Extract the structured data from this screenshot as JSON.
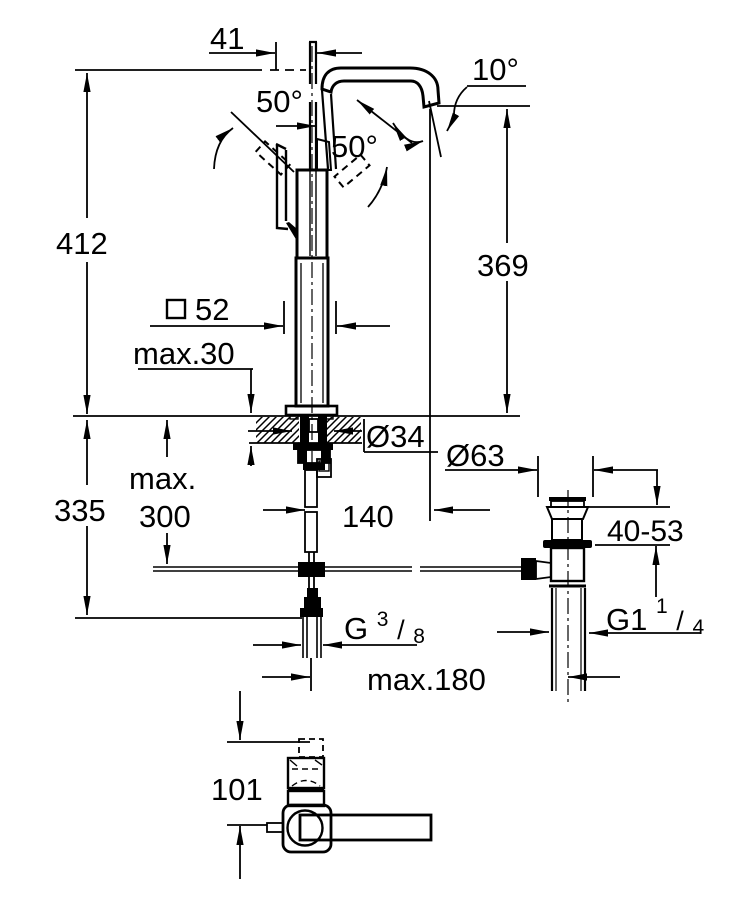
{
  "drawing": {
    "kind": "faucet-installation-dimensions",
    "dimensions": {
      "spout_offset": "41",
      "lever_angle_left": "50°",
      "lever_angle_right": "50°",
      "spout_angle": "10°",
      "total_height": "412",
      "spout_height": "369",
      "body_square_symbol": "□",
      "body_square_value": "52",
      "deck_max_thickness": "max.30",
      "hose_max_word": "max.",
      "hose_max_value": "300",
      "below_deck_height": "335",
      "spout_reach": "140",
      "hole_diameter": "Ø34",
      "waste_flange_diameter": "Ø63",
      "waste_height_range": "40-53",
      "supply_thread_main": "G",
      "supply_thread_num": "3",
      "supply_thread_slash": "/",
      "supply_thread_den": "8",
      "waste_thread_main": "G1",
      "waste_thread_num": "1",
      "waste_thread_slash": "/",
      "waste_thread_den": "4",
      "rod_max_distance": "max.180",
      "front_view_height": "101"
    }
  }
}
